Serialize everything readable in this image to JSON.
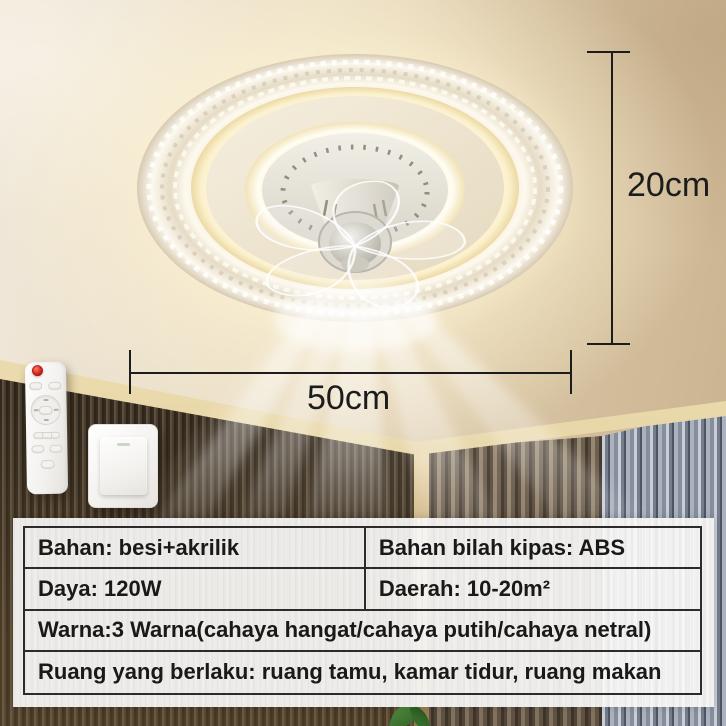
{
  "annotations": {
    "height_label": "20cm",
    "diameter_label": "50cm"
  },
  "spec_table": {
    "rows": [
      {
        "left": "Bahan: besi+akrilik",
        "right": "Bahan bilah kipas: ABS"
      },
      {
        "left": "Daya: 120W",
        "right": "Daerah: 10-20m²"
      },
      {
        "full": "Warna:3 Warna(cahaya hangat/cahaya putih/cahaya netral)"
      },
      {
        "full": "Ruang yang berlaku: ruang tamu, kamar tidur, ruang makan"
      }
    ]
  },
  "colors": {
    "annotation_text": "#1c1c1c",
    "table_border": "#2b2b2b",
    "table_text": "#191919",
    "panel_background": "#faf9f7",
    "remote_power_button": "#d2231d",
    "warm_glow": "#ffeebb",
    "curtain_blue_gray": "#98a0ac",
    "wall_slat_dark": "#3b332a"
  }
}
